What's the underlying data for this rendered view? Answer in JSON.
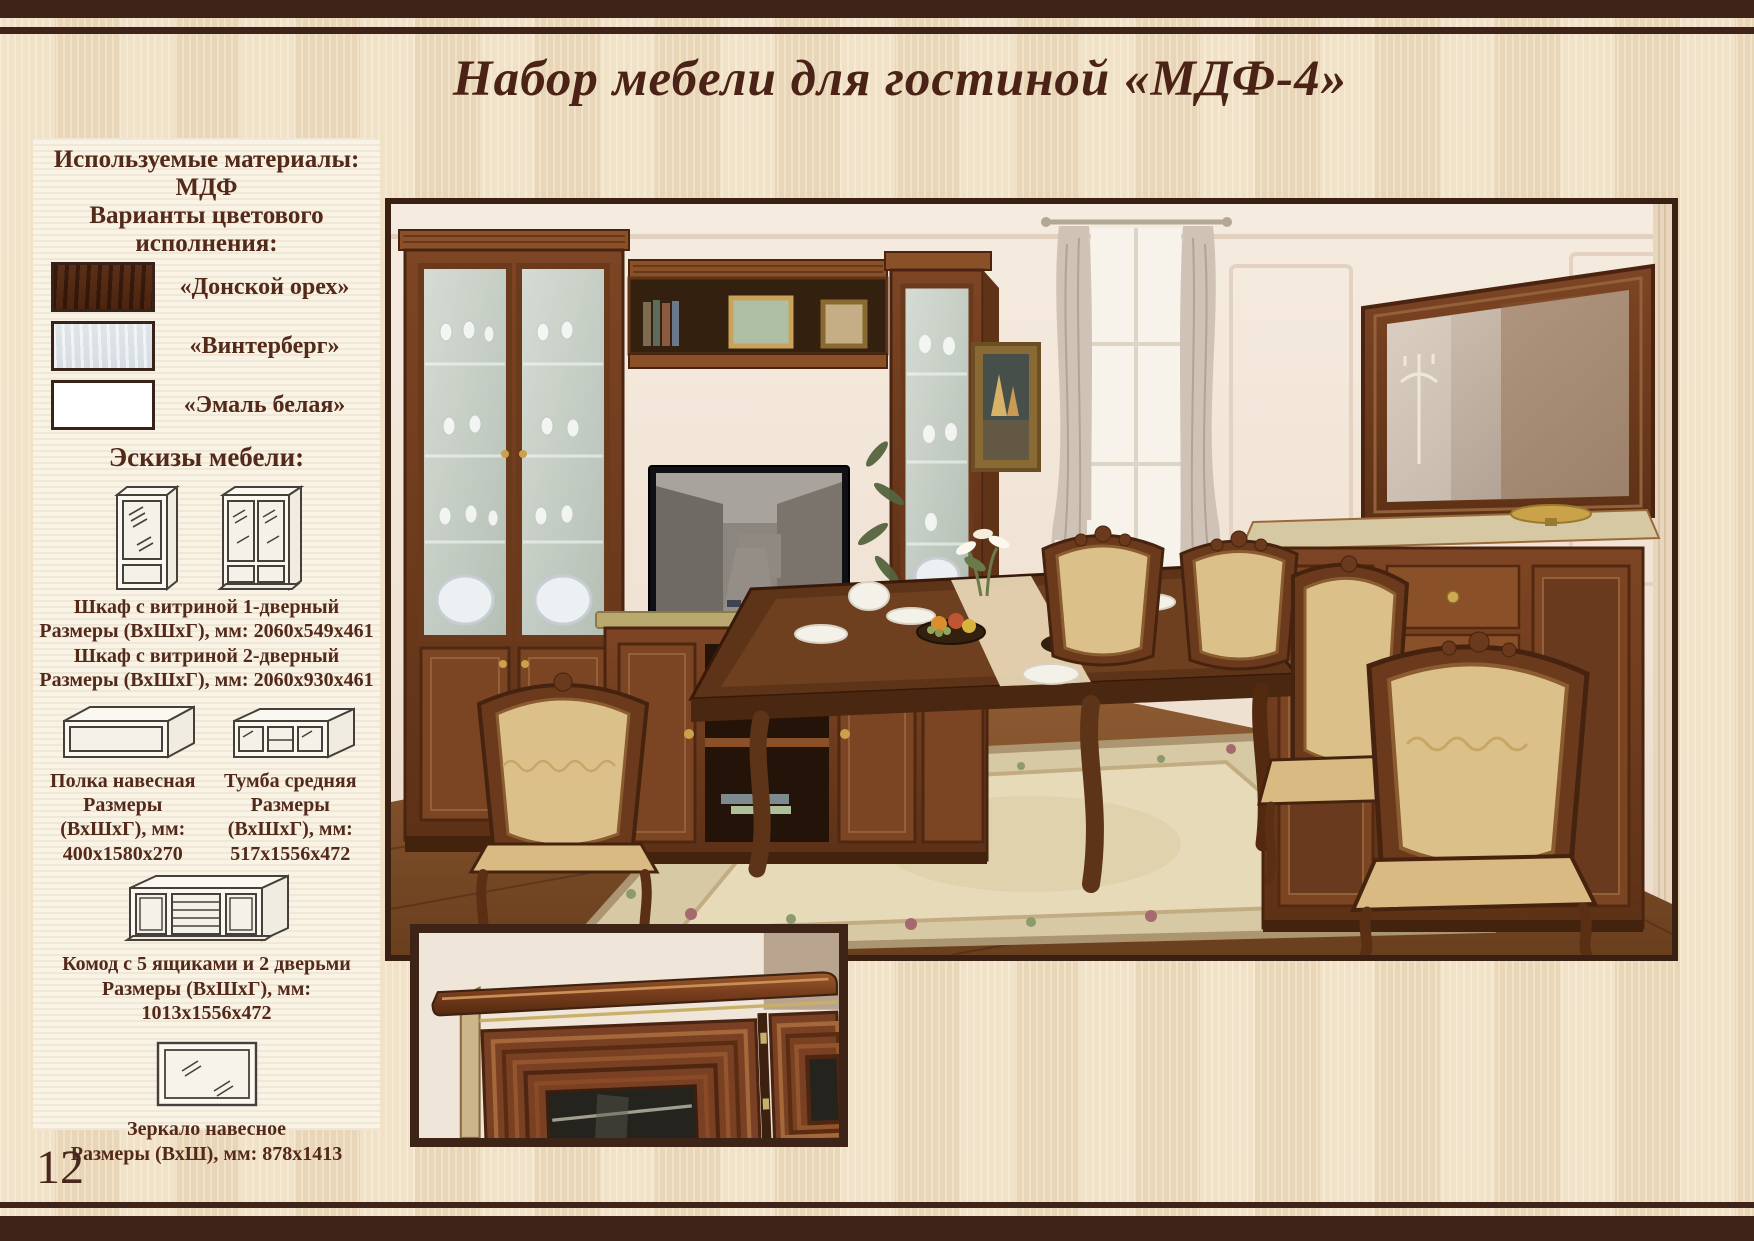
{
  "page": {
    "title": "Набор мебели для гостиной «МДФ-4»",
    "page_number": "12"
  },
  "sidebar": {
    "materials": {
      "heading": "Используемые материалы:",
      "value": "МДФ"
    },
    "colors_heading": "Варианты цветового исполнения:",
    "swatches": [
      {
        "label": "«Донской орех»",
        "color": "#5c3017"
      },
      {
        "label": "«Винтерберг»",
        "color": "#dfe4e8"
      },
      {
        "label": "«Эмаль белая»",
        "color": "#ffffff"
      }
    ],
    "sketches_heading": "Эскизы мебели:",
    "items": [
      {
        "name": "Шкаф с витриной 1-дверный",
        "dims": "Размеры (ВхШхГ), мм: 2060х549х461"
      },
      {
        "name": "Шкаф с витриной 2-дверный",
        "dims": "Размеры (ВхШхГ), мм: 2060х930х461"
      },
      {
        "name": "Полка навесная",
        "dims": "Размеры (ВхШхГ), мм: 400х1580х270"
      },
      {
        "name": "Тумба средняя",
        "dims": "Размеры (ВхШхГ), мм: 517х1556х472"
      },
      {
        "name": "Комод с 5 ящиками и 2 дверьми",
        "dims": "Размеры (ВхШхГ), мм: 1013х1556х472"
      },
      {
        "name": "Зеркало навесное",
        "dims": "Размеры (ВхШ), мм: 878х1413"
      }
    ]
  },
  "theme": {
    "top_bottom_bars": "#3f2318",
    "title_color": "#4b2316",
    "panel_bg": "#f9f3e6",
    "photo_border": "#392013",
    "background_wood": "#edd9bb"
  }
}
